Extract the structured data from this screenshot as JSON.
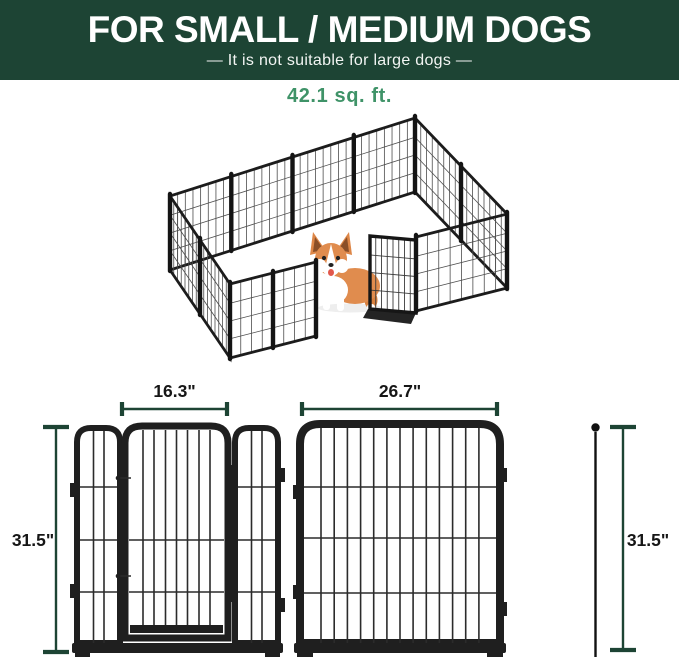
{
  "banner": {
    "title": "FOR SMALL / MEDIUM DOGS",
    "subtitle": "—  It is not suitable for large dogs  —"
  },
  "area": {
    "label": "42.1 sq. ft."
  },
  "diagrams": {
    "gate_panel": {
      "width_label": "16.3\"",
      "height_label": "31.5\""
    },
    "regular_panel": {
      "width_label": "26.7\"",
      "height_label": "31.5\""
    }
  },
  "colors": {
    "banner_bg": "#1d4434",
    "banner_text": "#ffffff",
    "accent_green": "#3f9368",
    "dimension_line": "#1d4434",
    "frame_black": "#1c1c1c",
    "dog_fur": "#e08c4e"
  }
}
